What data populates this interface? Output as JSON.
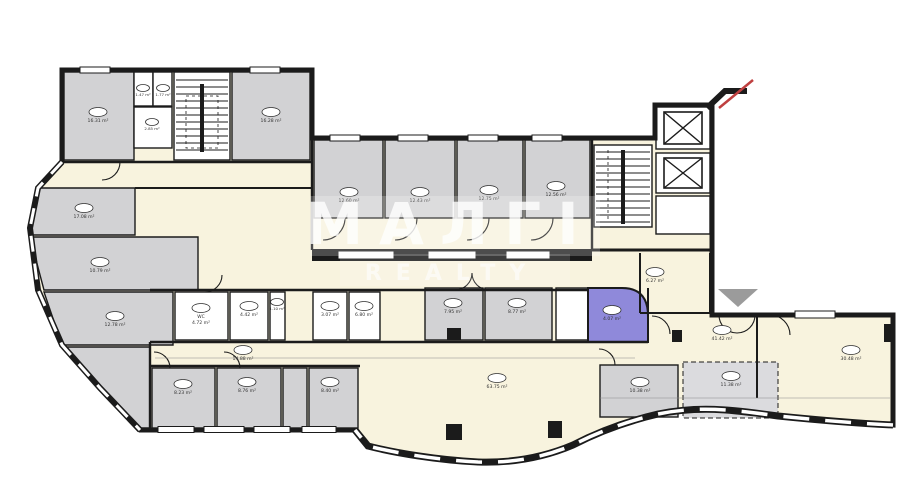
{
  "watermark": {
    "line1": "МАЛГІ",
    "line2": "REALTY"
  },
  "colors": {
    "wall": "#1b1b1b",
    "room_gray": "#d2d2d4",
    "room_gray_light": "#dbdbde",
    "corridor_cream": "#f8f3de",
    "room_white": "#ffffff",
    "room_purple": "#8f89da",
    "triangle_gray": "#9b9b9b",
    "mark_red": "#bf4040",
    "label_ink": "#333333"
  },
  "rooms": [
    {
      "area": "16.31 m²",
      "x": 98,
      "y": 112
    },
    {
      "area": "1.47 m²",
      "x": 143,
      "y": 88,
      "small": true
    },
    {
      "area": "1.77 m²",
      "x": 163,
      "y": 88,
      "small": true
    },
    {
      "area": "2.85 m²",
      "x": 152,
      "y": 122,
      "small": true
    },
    {
      "area": "16.28 m²",
      "x": 271,
      "y": 112
    },
    {
      "area": "17.08 m²",
      "x": 84,
      "y": 208
    },
    {
      "area": "10.79 m²",
      "x": 100,
      "y": 262
    },
    {
      "area": "12.78 m²",
      "x": 115,
      "y": 316
    },
    {
      "area": "12.60 m²",
      "x": 349,
      "y": 192
    },
    {
      "area": "12.43 m²",
      "x": 420,
      "y": 192
    },
    {
      "area": "12.75 m²",
      "x": 489,
      "y": 190
    },
    {
      "area": "12.56 m²",
      "x": 556,
      "y": 186
    },
    {
      "type": "WC",
      "area": "4.72 m²",
      "x": 201,
      "y": 308
    },
    {
      "area": "4.42 m²",
      "x": 249,
      "y": 306
    },
    {
      "area": "1.10 m²",
      "x": 277,
      "y": 302,
      "small": true
    },
    {
      "area": "3.07 m²",
      "x": 330,
      "y": 306
    },
    {
      "area": "6.80 m²",
      "x": 364,
      "y": 306
    },
    {
      "area": "7.95 m²",
      "x": 453,
      "y": 303
    },
    {
      "area": "8.77 m²",
      "x": 517,
      "y": 303
    },
    {
      "area": "4.07 m²",
      "x": 612,
      "y": 310
    },
    {
      "area": "14.88 m²",
      "x": 243,
      "y": 350
    },
    {
      "area": "8.23 m²",
      "x": 183,
      "y": 384
    },
    {
      "area": "8.76 m²",
      "x": 247,
      "y": 382
    },
    {
      "area": "8.40 m²",
      "x": 330,
      "y": 382
    },
    {
      "area": "63.75 m²",
      "x": 497,
      "y": 378
    },
    {
      "area": "6.27 m²",
      "x": 655,
      "y": 272
    },
    {
      "area": "41.42 m²",
      "x": 722,
      "y": 330
    },
    {
      "area": "10.38 m²",
      "x": 640,
      "y": 382
    },
    {
      "area": "11.38 m²",
      "x": 731,
      "y": 376
    },
    {
      "area": "30.48 m²",
      "x": 851,
      "y": 350
    }
  ]
}
